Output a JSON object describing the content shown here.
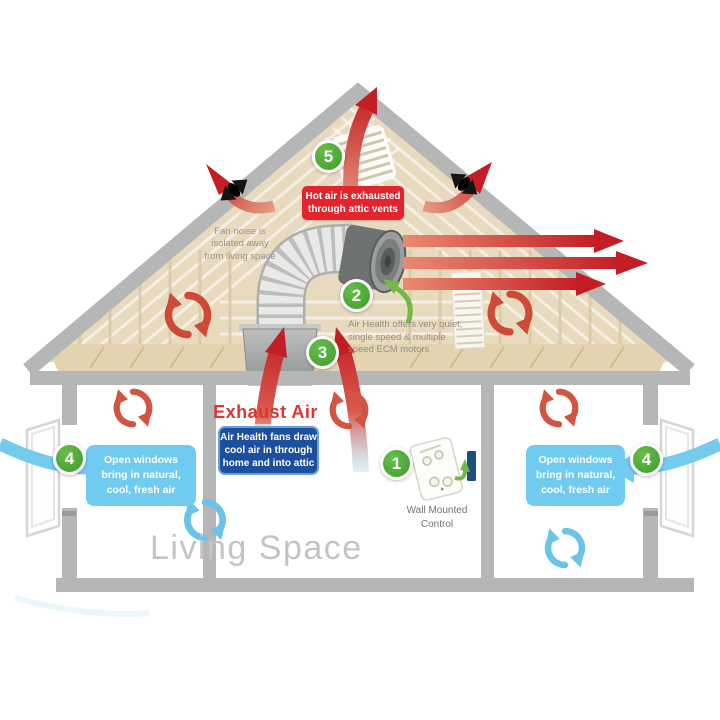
{
  "colors": {
    "badge_green": "#4aa52f",
    "arrow_red": "#c41e25",
    "hot_air_box_red": "#e2242d",
    "fans_draw_box_navy": "#1c4f9e",
    "open_windows_box_blue": "#70cbf0",
    "swirl_blue": "#6ac4e8",
    "structure_gray": "#b5b7b6",
    "attic_tan": "#e8dabf"
  },
  "badges": {
    "n1": "1",
    "n2": "2",
    "n3": "3",
    "n4": "4",
    "n5": "5"
  },
  "attic": {
    "hot_air_vent_box": {
      "line1": "Hot air is exhausted",
      "line2": "through attic vents"
    },
    "fan_noise_note": {
      "line1": "Fan noise is",
      "line2": "isolated away",
      "line3": "from living space"
    },
    "motors_note": {
      "line1": "Air Health offers very quiet,",
      "line2": "single speed & multiple",
      "line3": "speed ECM motors"
    }
  },
  "living_space": {
    "room_label": "Living Space",
    "exhaust_air_label": "Exhaust Air",
    "fans_draw_box": {
      "line1": "Air Health fans draw",
      "line2": "cool air in through",
      "line3": "home and into attic"
    },
    "open_windows_left": {
      "line1": "Open windows",
      "line2": "bring in natural,",
      "line3": "cool, fresh air"
    },
    "open_windows_right": {
      "line1": "Open windows",
      "line2": "bring in natural,",
      "line3": "cool, fresh air"
    },
    "wall_control_label": {
      "line1": "Wall Mounted",
      "line2": "Control"
    }
  }
}
